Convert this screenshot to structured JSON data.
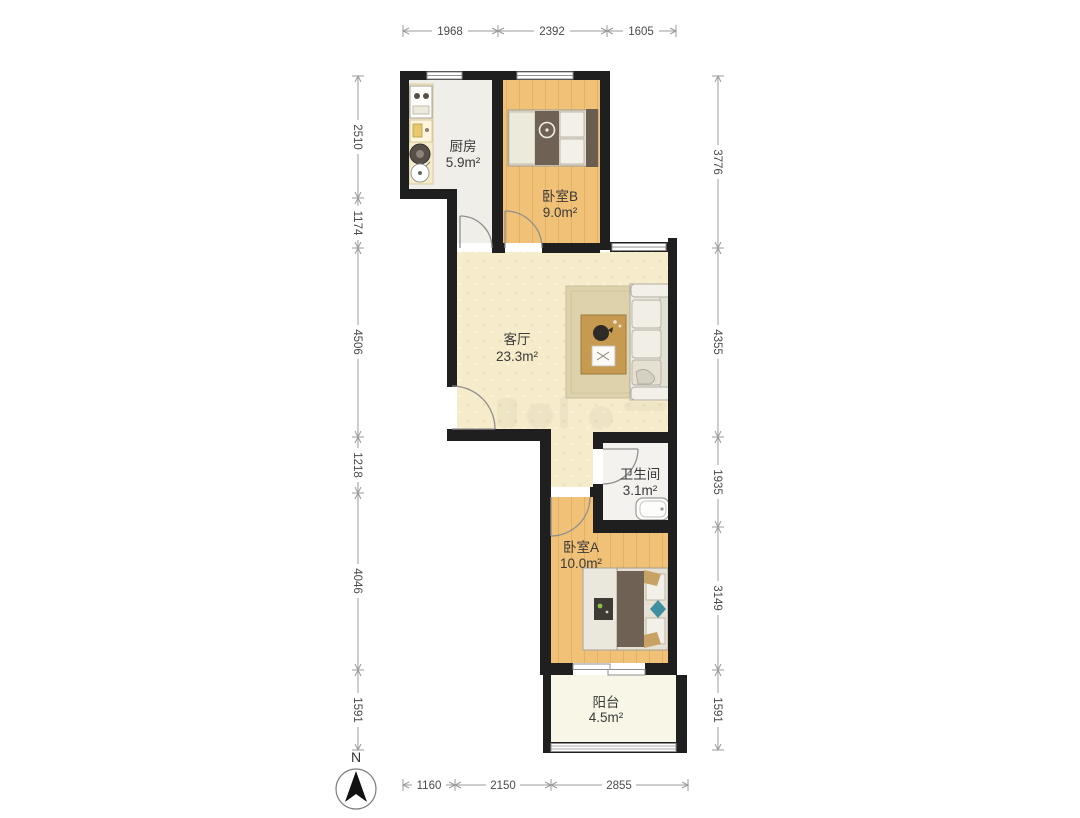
{
  "plan": {
    "rooms": {
      "kitchen": {
        "name": "厨房",
        "area": "5.9m²"
      },
      "bedroom_b": {
        "name": "卧室B",
        "area": "9.0m²"
      },
      "living_room": {
        "name": "客厅",
        "area": "23.3m²"
      },
      "bathroom": {
        "name": "卫生间",
        "area": "3.1m²"
      },
      "bedroom_a": {
        "name": "卧室A",
        "area": "10.0m²"
      },
      "balcony": {
        "name": "阳台",
        "area": "4.5m²"
      }
    },
    "colors": {
      "wall": "#1f1f1f",
      "wood_floor": "#f0c177",
      "living_floor": "#f6eccb",
      "kitchen_floor": "#efeee8",
      "bathroom_floor": "#f3f2ee",
      "balcony_floor": "#f8f6e7",
      "dimension_line": "#9b9b9b",
      "dimension_text": "#4a4a4a",
      "label_text": "#3a3a3a"
    }
  },
  "dimensions": {
    "top": [
      "1968",
      "2392",
      "1605"
    ],
    "left": [
      "2510",
      "1174",
      "4506",
      "1218",
      "4046",
      "1591"
    ],
    "right": [
      "3776",
      "4355",
      "1935",
      "3149",
      "1591"
    ],
    "bottom": [
      "1160",
      "2150",
      "2855"
    ]
  },
  "compass": {
    "label": "N"
  }
}
